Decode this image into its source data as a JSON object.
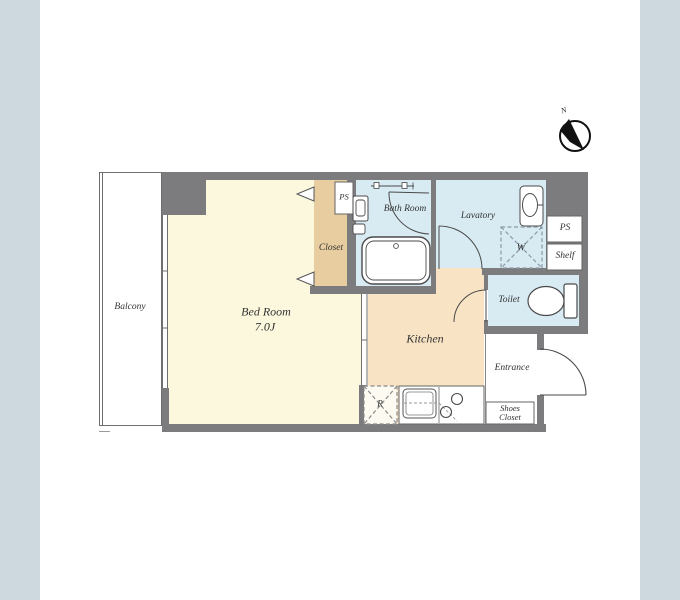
{
  "colors": {
    "band": "#cdd8df",
    "wall": "#7c7c7e",
    "bedroom": "#fbf8dd",
    "closet": "#e8cda0",
    "kitchen": "#f8e4c4",
    "wet": "#d8ebf2",
    "text": "#333333",
    "line": "#4a4a4a"
  },
  "floorplan": {
    "compass": {
      "north": "N"
    },
    "rooms": {
      "balcony": {
        "label": "Balcony"
      },
      "bedroom": {
        "label": "Bed Room",
        "size": "7.0J"
      },
      "closet": {
        "label": "Closet"
      },
      "ps_top": {
        "label": "PS"
      },
      "bathroom": {
        "label": "Bath Room"
      },
      "lavatory": {
        "label": "Lavatory"
      },
      "ps_side": {
        "label": "PS"
      },
      "shelf": {
        "label": "Shelf"
      },
      "toilet": {
        "label": "Toilet"
      },
      "kitchen": {
        "label": "Kitchen"
      },
      "entrance": {
        "label": "Entrance"
      },
      "shoes_closet": {
        "label_line1": "Shoes",
        "label_line2": "Closet"
      }
    },
    "fixtures": {
      "washer_space": {
        "label": "W"
      },
      "refrigerator_space": {
        "label": "R"
      }
    }
  }
}
